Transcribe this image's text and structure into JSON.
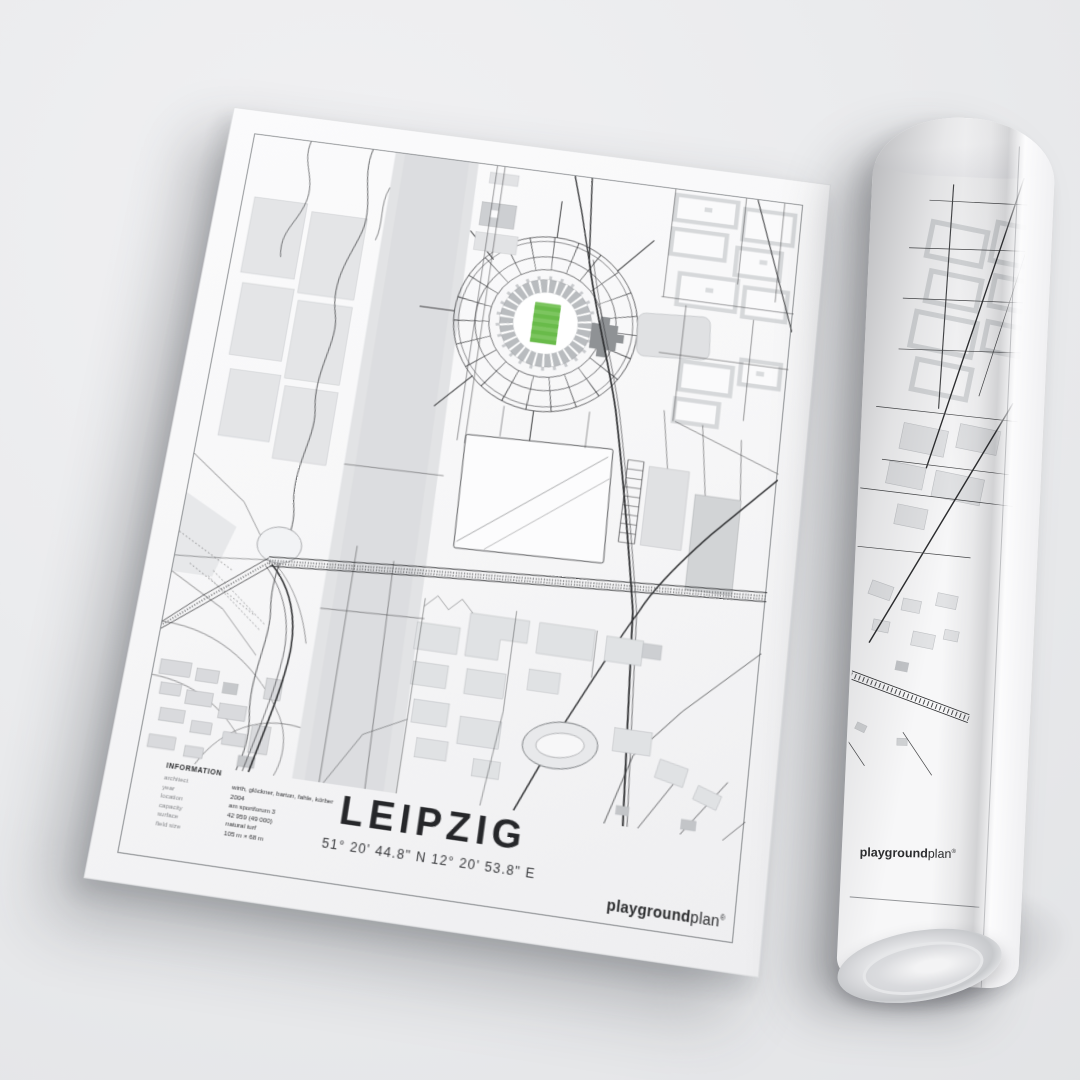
{
  "poster": {
    "title": "LEIPZIG",
    "coordinates": "51° 20' 44.8\" N  12° 20' 53.8\" E",
    "information": {
      "heading": "INFORMATION",
      "rows": [
        {
          "label": "architect",
          "value": "wirth, glöckner, barton, fahle, körber"
        },
        {
          "label": "year",
          "value": "2004"
        },
        {
          "label": "location",
          "value": "am sportforum 3"
        },
        {
          "label": "capacity",
          "value": "42 959 (49 000)"
        },
        {
          "label": "surface",
          "value": "natural turf"
        },
        {
          "label": "field size",
          "value": "105 m × 68 m"
        }
      ]
    },
    "brand": {
      "bold": "playground",
      "light": "plan",
      "mark": "®"
    },
    "map": {
      "colors": {
        "water": "#e2e3e5",
        "water_inner": "#dcdde0",
        "pitch_green": "#7cc55f",
        "pitch_stripe": "#69bb4a",
        "stands_gray": "#b9bcbf",
        "structure_gray": "#8f9295",
        "block_gray": "#e3e4e6",
        "road_dark": "#2b2c2e"
      }
    }
  },
  "rolled_poster": {
    "brand": {
      "bold": "playground",
      "light": "plan",
      "mark": "®"
    }
  }
}
